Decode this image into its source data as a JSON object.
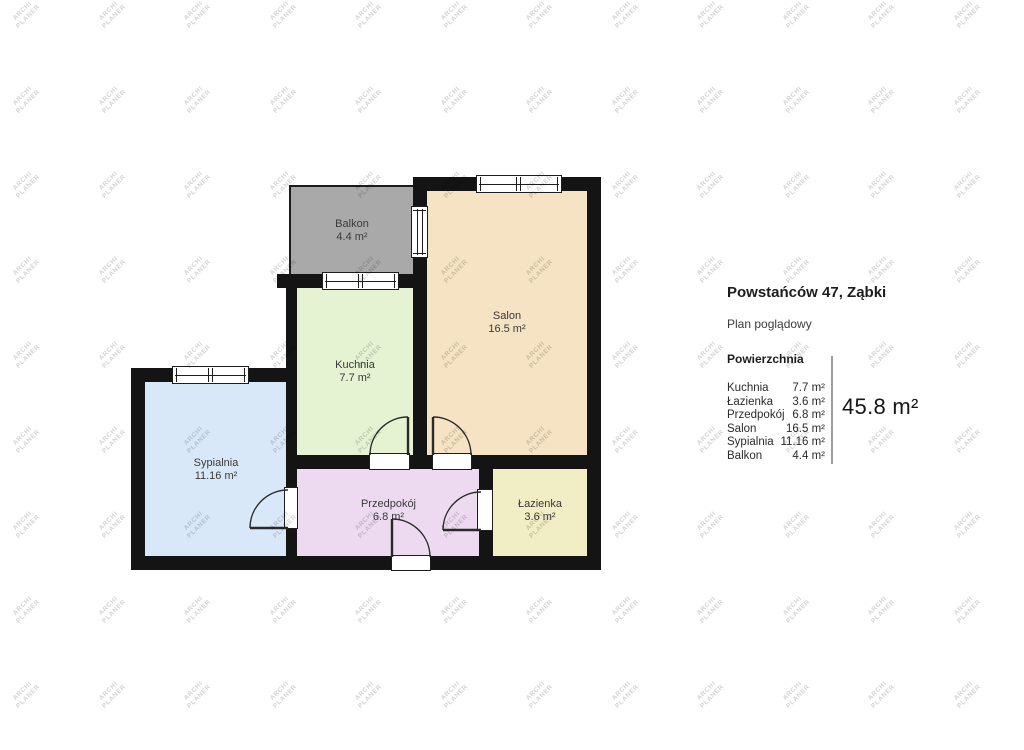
{
  "watermark": {
    "line1": "ARCHI",
    "line2": "PLANER"
  },
  "plan": {
    "wall_color": "#141414",
    "rooms": [
      {
        "name": "Balkon",
        "area": "4.4 m²",
        "color": "#a9a9a9"
      },
      {
        "name": "Salon",
        "area": "16.5 m²",
        "color": "#f5e3c3"
      },
      {
        "name": "Kuchnia",
        "area": "7.7 m²",
        "color": "#e5f3d3"
      },
      {
        "name": "Sypialnia",
        "area": "11.16 m²",
        "color": "#d9e8f8"
      },
      {
        "name": "Przedpokój",
        "area": "6.8 m²",
        "color": "#eddaf1"
      },
      {
        "name": "Łazienka",
        "area": "3.6 m²",
        "color": "#f1edc5"
      }
    ]
  },
  "panel": {
    "title": "Powstańców 47, Ząbki",
    "subtitle": "Plan poglądowy",
    "section_header": "Powierzchnia",
    "rows": [
      {
        "label": "Kuchnia",
        "value": "7.7 m²"
      },
      {
        "label": "Łazienka",
        "value": "3.6 m²"
      },
      {
        "label": "Przedpokój",
        "value": "6.8 m²"
      },
      {
        "label": "Salon",
        "value": "16.5 m²"
      },
      {
        "label": "Sypialnia",
        "value": "11.16 m²"
      },
      {
        "label": "Balkon",
        "value": "4.4 m²"
      }
    ],
    "total": "45.8 m²"
  }
}
